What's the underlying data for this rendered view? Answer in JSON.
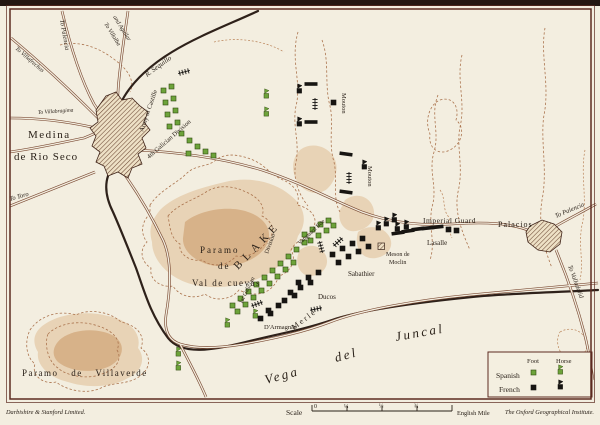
{
  "map": {
    "towns": {
      "medina_line1": "Medina",
      "medina_line2": "de Rio Seco",
      "palacios": "Palacios"
    },
    "river": {
      "name": "R. Sequillo"
    },
    "roads": {
      "to_palencia_north": "To Palencia",
      "to_villalba_line1": "To Villalba",
      "to_villalba_line2": "and Aguilar",
      "to_villafrechos": "To Villafrechos",
      "to_villabragima": "To Villabragima",
      "to_toro": "To Toro",
      "to_palencia_east": "To Palencia",
      "to_valladolid": "To Valladolid"
    },
    "regions": {
      "paramo_cuevas_line1": "Paramo",
      "paramo_cuevas_line2": "de",
      "paramo_cuevas_line3": "Val de cuevas",
      "paramo_villaverde": "Paramo de Villaverde",
      "vega_word1": "Vega",
      "vega_word2": "del",
      "vega_word3": "Juncal"
    },
    "spanish_units": {
      "commander": "BLAKE",
      "army_of_castille": "Army of Castille",
      "fourth_galician": "4th Galician Division",
      "first_galician": "1st Galician",
      "first_galician_division": "Division",
      "vanguard": "Vanguard Bde"
    },
    "french_units": {
      "mouton_north": "Mouton",
      "mouton_south": "Mouton",
      "imperial_guard": "Imperial Guard",
      "lasalle": "Lasalle",
      "sabathier": "Sabathier",
      "ducos": "Ducos",
      "darmagnac": "D'Armagnac",
      "merle": "Merle",
      "meson_line1": "Meson de",
      "meson_line2": "Moclin"
    },
    "legend": {
      "col_foot": "Foot",
      "col_horse": "Horse",
      "row_spanish": "Spanish",
      "row_french": "French"
    },
    "footer": {
      "publisher": "Darbishire & Stanford Limited.",
      "scale_label": "Scale",
      "scale_ticks": [
        "0",
        "¼",
        "½",
        "¾"
      ],
      "scale_unit": "English Mile",
      "institute": "The Oxford Geographical Institute."
    },
    "colors": {
      "spanish": "#6da33a",
      "spanish_edge": "#31490f",
      "french": "#171512",
      "ink": "#2a2119"
    },
    "units": {
      "spanish_foot": [
        [
          163,
          100
        ],
        [
          165,
          112
        ],
        [
          167,
          124
        ],
        [
          171,
          96
        ],
        [
          173,
          108
        ],
        [
          175,
          120
        ],
        [
          179,
          131
        ],
        [
          187,
          138
        ],
        [
          195,
          144
        ],
        [
          203,
          149
        ],
        [
          211,
          153
        ],
        [
          161,
          88
        ],
        [
          169,
          84
        ],
        [
          186,
          151
        ],
        [
          230,
          303
        ],
        [
          238,
          296
        ],
        [
          246,
          289
        ],
        [
          254,
          282
        ],
        [
          262,
          275
        ],
        [
          270,
          268
        ],
        [
          278,
          261
        ],
        [
          286,
          254
        ],
        [
          294,
          247
        ],
        [
          302,
          240
        ],
        [
          235,
          309
        ],
        [
          243,
          302
        ],
        [
          251,
          295
        ],
        [
          259,
          288
        ],
        [
          267,
          281
        ],
        [
          275,
          274
        ],
        [
          283,
          267
        ],
        [
          291,
          260
        ],
        [
          302,
          232
        ],
        [
          310,
          227
        ],
        [
          318,
          222
        ],
        [
          326,
          218
        ],
        [
          308,
          238
        ],
        [
          316,
          233
        ],
        [
          324,
          228
        ],
        [
          331,
          223
        ]
      ],
      "spanish_horse": [
        [
          264,
          92
        ],
        [
          264,
          110
        ],
        [
          176,
          350
        ],
        [
          176,
          364
        ],
        [
          253,
          312
        ],
        [
          225,
          321
        ]
      ],
      "french_foot": [
        [
          330,
          252
        ],
        [
          340,
          246
        ],
        [
          350,
          241
        ],
        [
          360,
          236
        ],
        [
          336,
          260
        ],
        [
          346,
          254
        ],
        [
          356,
          249
        ],
        [
          366,
          244
        ],
        [
          296,
          280
        ],
        [
          306,
          275
        ],
        [
          316,
          270
        ],
        [
          288,
          290
        ],
        [
          298,
          285
        ],
        [
          308,
          280
        ],
        [
          282,
          298
        ],
        [
          292,
          293
        ],
        [
          266,
          308
        ],
        [
          276,
          303
        ],
        [
          258,
          316
        ],
        [
          268,
          311
        ],
        [
          331,
          100
        ],
        [
          446,
          227
        ],
        [
          454,
          228
        ]
      ],
      "french_horse": [
        [
          297,
          87
        ],
        [
          297,
          120
        ],
        [
          362,
          163
        ],
        [
          376,
          224
        ],
        [
          384,
          220
        ],
        [
          392,
          216
        ],
        [
          395,
          225
        ],
        [
          404,
          223
        ]
      ],
      "french_bar": [
        [
          311,
          84,
          0
        ],
        [
          311,
          122,
          0
        ],
        [
          346,
          154,
          8
        ],
        [
          346,
          192,
          8
        ],
        [
          398,
          233,
          -8
        ],
        [
          408,
          231,
          -8
        ],
        [
          418,
          229,
          -7
        ],
        [
          428,
          228,
          -6
        ],
        [
          437,
          227,
          -6
        ]
      ],
      "artillery": [
        [
          184,
          72,
          -15
        ],
        [
          315,
          104,
          90
        ],
        [
          349,
          178,
          90
        ],
        [
          338,
          242,
          -42
        ],
        [
          321,
          247,
          75
        ],
        [
          316,
          309,
          -12
        ],
        [
          257,
          304,
          -20
        ]
      ],
      "buildings": [
        [
          378,
          243
        ]
      ]
    }
  }
}
